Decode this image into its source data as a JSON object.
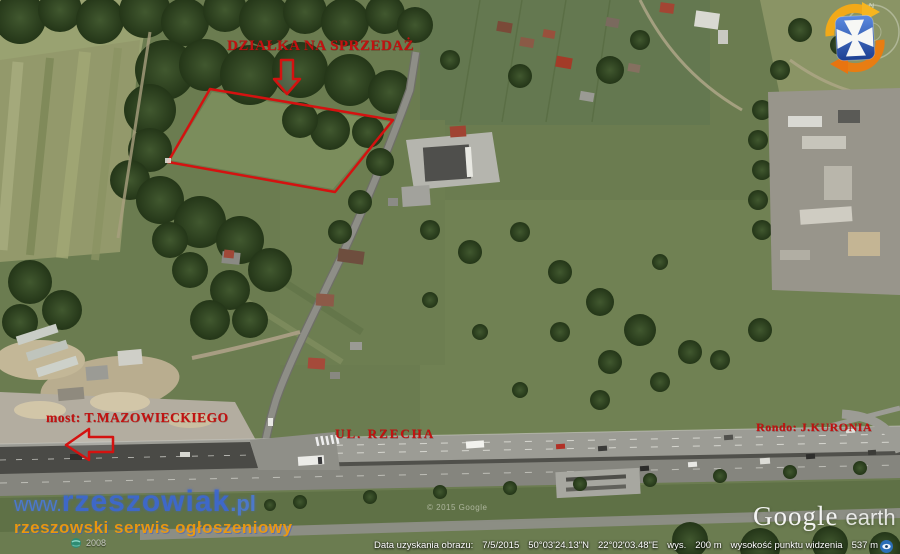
{
  "annotations": {
    "plot_for_sale_label": "DZIAŁKA NA SPRZEDAŻ",
    "bridge_label": "most: T.MAZOWIECKIEGO",
    "street_label": "UL. RZECHA",
    "roundabout_label": "Rondo: J.KURONIA"
  },
  "watermark": {
    "url_prefix": "www.",
    "site_name": "rzeszowiak",
    "url_suffix": ".pl",
    "tagline": "rzeszowski serwis ogłoszeniowy",
    "badge_year": "2008"
  },
  "status_bar": {
    "imagery_date_label": "Data uzyskania obrazu:",
    "imagery_date": "7/5/2015",
    "latitude": "50°03'24.13\"N",
    "longitude": "22°02'03.48\"E",
    "elevation_label": "wys.",
    "elevation_value": "200 m",
    "eye_altitude_label": "wysokość punktu widzenia",
    "eye_altitude_value": "537 m"
  },
  "branding": {
    "google": "Google",
    "earth": "earth",
    "copyright": "© 2015 Google"
  },
  "icons": {
    "logo": "rzeszow-cross-icon",
    "compass": "compass-ring",
    "status": "eye-icon",
    "attribution": "globe-icon",
    "plot_pointer": "down-arrow-icon",
    "bridge_pointer": "left-arrow-icon"
  },
  "colors": {
    "annotation_red": "#c31110",
    "watermark_blue": "#3d68cf",
    "watermark_orange": "#ef9a0e"
  }
}
